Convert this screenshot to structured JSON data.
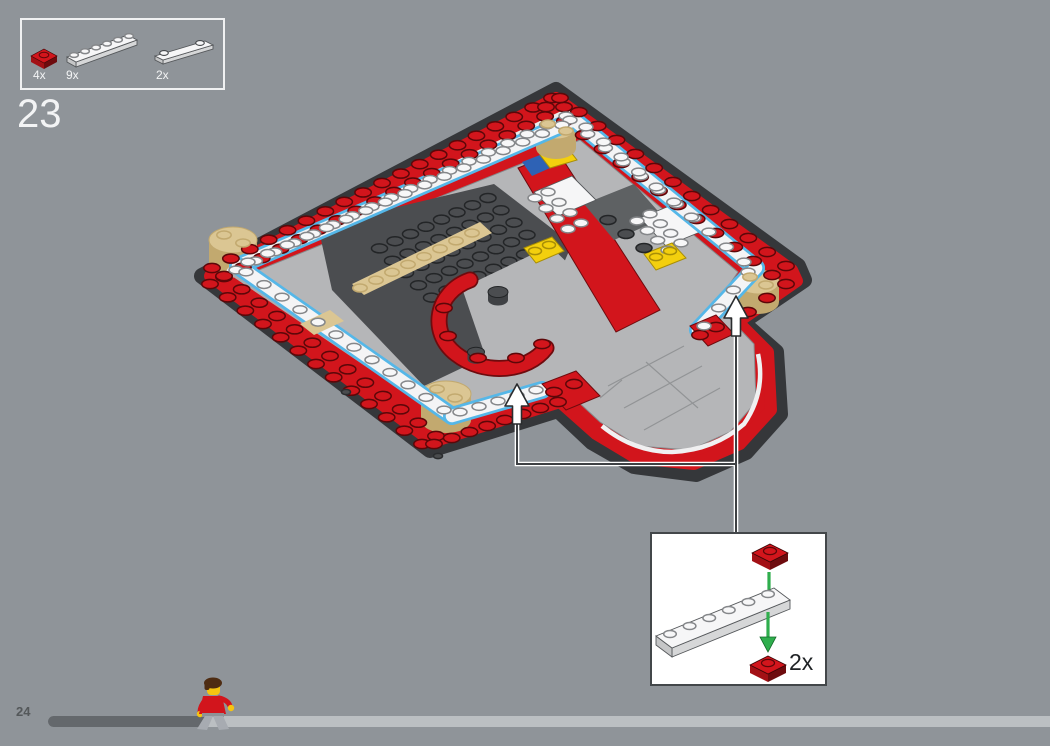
{
  "palette": {
    "background": "#8F9499",
    "red": "#D2151C",
    "red_side": "#A31015",
    "red_deep": "#6E0B0E",
    "white_piece": "#F6F6F7",
    "white_side": "#D6D7D8",
    "blue_outline": "#55B7E8",
    "tan": "#DBC693",
    "tan_side": "#C2A96F",
    "base_dark": "#35373A",
    "plate_dark": "#4B4D50",
    "gray_tile": "#B5B6B8",
    "yellow": "#F3CF0E",
    "yellow_deep": "#A88E07",
    "flag_blue": "#2E62B5",
    "green_arrow": "#2FAE4D",
    "green_deep": "#156B2A",
    "line_dark": "#3E4144",
    "box_border": "#F0F1F2",
    "callout_border": "#43474A",
    "callout_bg": "#FFFFFF",
    "callout_text": "#202326",
    "progress_track": "#BBBFC2",
    "progress_fill": "#64686C",
    "text_light": "#F3F4F5",
    "text_dark": "#54585A",
    "minifig_hair": "#4E2C12",
    "minifig_skin": "#F5C411",
    "minifig_torso": "#D2151C",
    "minifig_legs": "#A7ABB1"
  },
  "parts_panel": {
    "items": [
      {
        "count": "4x",
        "part": "red-1x1-plate"
      },
      {
        "count": "9x",
        "part": "white-1x6-plate"
      },
      {
        "count": "2x",
        "part": "white-1x4-plate-two-studs"
      }
    ]
  },
  "step": {
    "number": "23"
  },
  "callout": {
    "quantity": "2x",
    "parts": [
      "red-1x1-plate",
      "white-1x6-plate",
      "red-1x1-plate"
    ]
  },
  "footer": {
    "page_number": "24",
    "progress_percent": 16
  }
}
